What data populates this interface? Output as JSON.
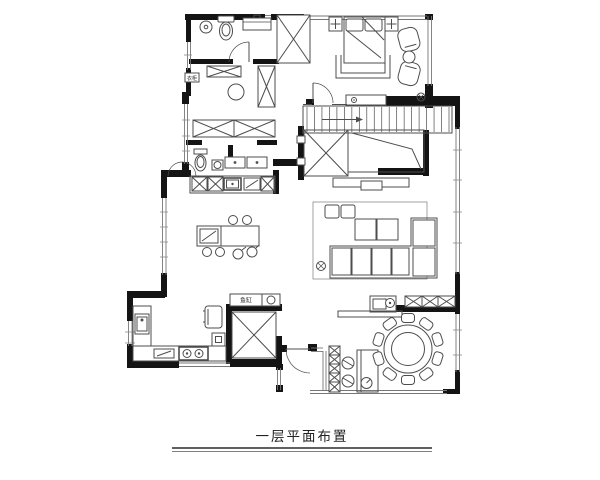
{
  "caption": {
    "text": "一层平面布置"
  },
  "plan_labels": {
    "fish_tank": "鱼缸",
    "closet_cabinet": "衣柜"
  },
  "colors": {
    "wall": "#141414",
    "line": "#4d4d4d",
    "light_line": "#8c8c8c",
    "window_line": "#777777",
    "background": "#ffffff"
  },
  "counts": {
    "stair_treads": 20,
    "dining_seats": 10,
    "island_stools": 4,
    "bar_stools": 2,
    "bedroom_armchairs": 2
  },
  "stair_direction_arrow": "right"
}
